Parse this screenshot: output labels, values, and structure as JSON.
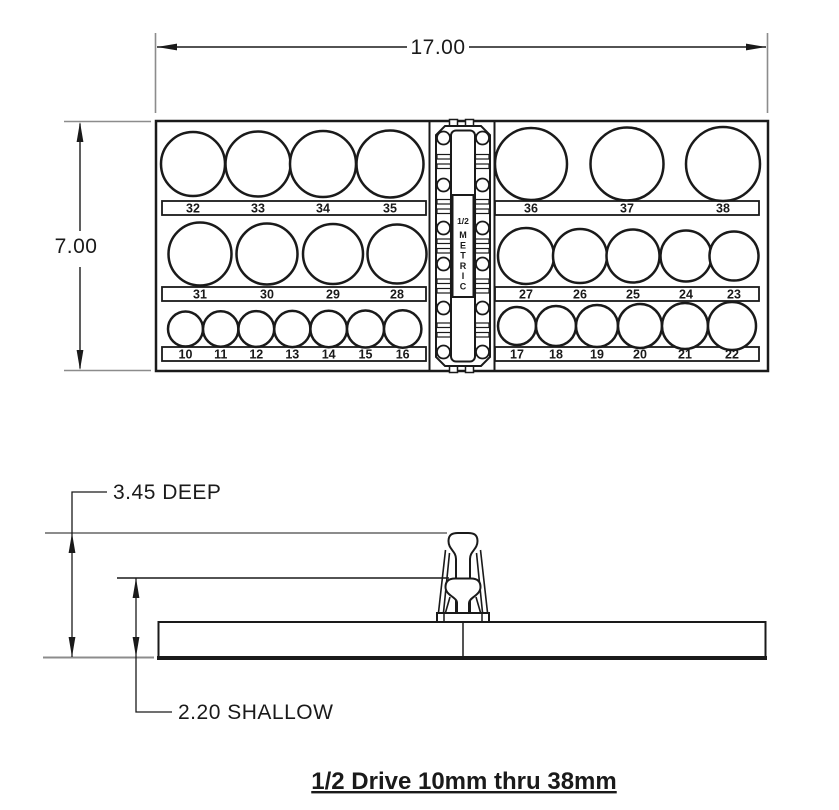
{
  "title": "1/2 Drive 10mm thru 38mm",
  "top_view": {
    "width_dim": "17.00",
    "height_dim": "7.00"
  },
  "side_view": {
    "deep_dim": "3.45 DEEP",
    "shallow_dim": "2.20 SHALLOW"
  },
  "hinge": {
    "size_label": "1/2",
    "system_label": "METRIC"
  },
  "socket_rows": [
    {
      "id": "row1-left",
      "labels": [
        "32",
        "33",
        "34",
        "35"
      ]
    },
    {
      "id": "row1-right",
      "labels": [
        "36",
        "37",
        "38"
      ]
    },
    {
      "id": "row2-left",
      "labels": [
        "31",
        "30",
        "29",
        "28"
      ]
    },
    {
      "id": "row2-right",
      "labels": [
        "27",
        "26",
        "25",
        "24",
        "23"
      ]
    },
    {
      "id": "row3-left",
      "labels": [
        "10",
        "11",
        "12",
        "13",
        "14",
        "15",
        "16"
      ]
    },
    {
      "id": "row3-right",
      "labels": [
        "17",
        "18",
        "19",
        "20",
        "21",
        "22"
      ]
    }
  ],
  "colors": {
    "line": "#1a1a1a",
    "reference_line": "#8c8c8c",
    "background": "#ffffff"
  }
}
